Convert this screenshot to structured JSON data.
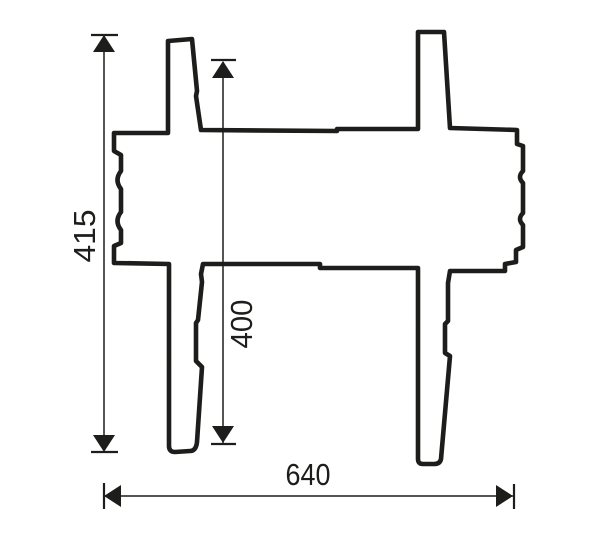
{
  "drawing": {
    "background_color": "#ffffff",
    "line_color": "#1d1d1b",
    "dimensions": {
      "overall_height": {
        "value": "415",
        "orientation": "vertical"
      },
      "inner_height": {
        "value": "400",
        "orientation": "vertical"
      },
      "overall_width": {
        "value": "640",
        "orientation": "horizontal"
      }
    }
  }
}
